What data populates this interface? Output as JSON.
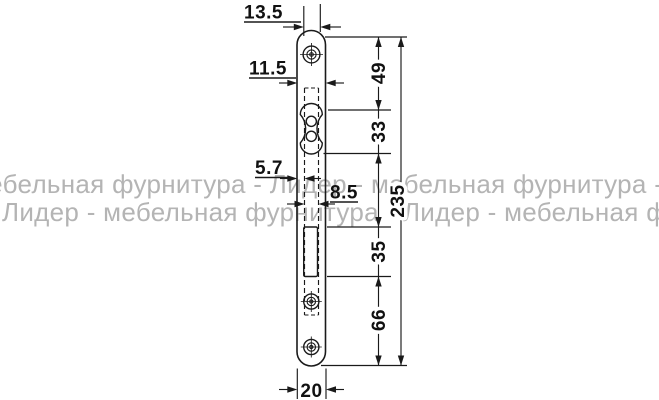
{
  "watermark": {
    "line1": "мебельная фурнитура - Лидер - мебельная фурнитура - Лидер",
    "line2": "Лидер - мебельная фурнитура - Лидер - мебельная фурнитура",
    "color": "#b4b4b4"
  },
  "drawing": {
    "ink_color": "#1a1a1a",
    "dims": {
      "plate_top_width": "13.5",
      "case_width": "11.5",
      "top_section": "49",
      "cylinder_section": "33",
      "edge_offset": "5.7",
      "guide_width": "8.5",
      "overall_length": "235",
      "latch_section": "35",
      "bottom_section": "66",
      "plate_width": "20"
    }
  }
}
